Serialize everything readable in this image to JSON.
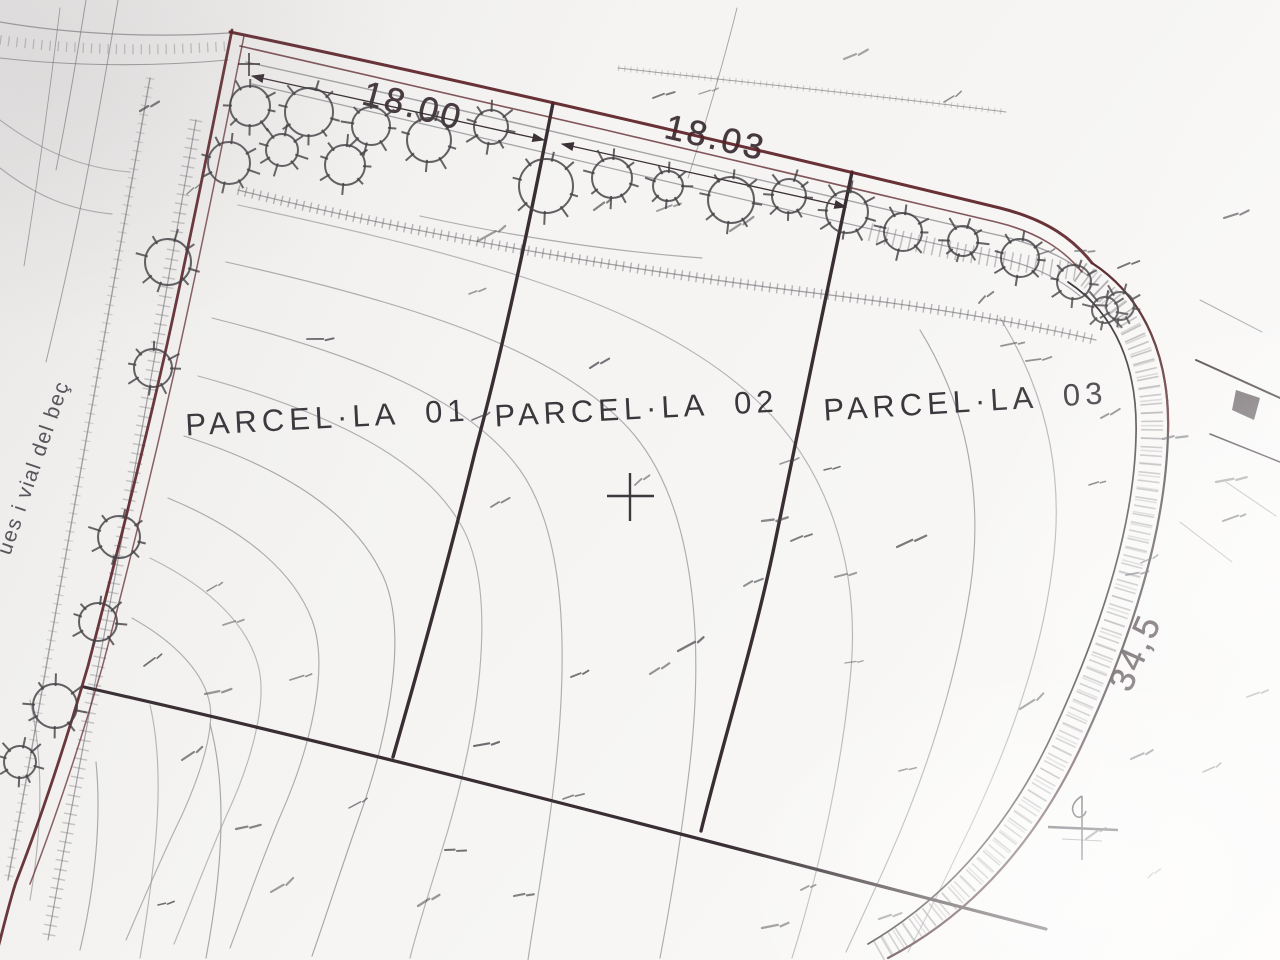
{
  "labels": {
    "dim_top_left": "18.00",
    "dim_top_right": "18.03",
    "dim_right_side": "34,5",
    "street_partial": "ues i vial del beç"
  },
  "parcels": [
    {
      "label": "PARCEL·LA 01"
    },
    {
      "label": "PARCEL·LA 02"
    },
    {
      "label": "PARCEL·LA 03"
    }
  ],
  "colors": {
    "paper": "#f6f5f2",
    "boundary_maroon": "#5a2026",
    "line_dark": "#382e33",
    "contour_gray": "#928f96",
    "text_ink": "#3b383d"
  }
}
